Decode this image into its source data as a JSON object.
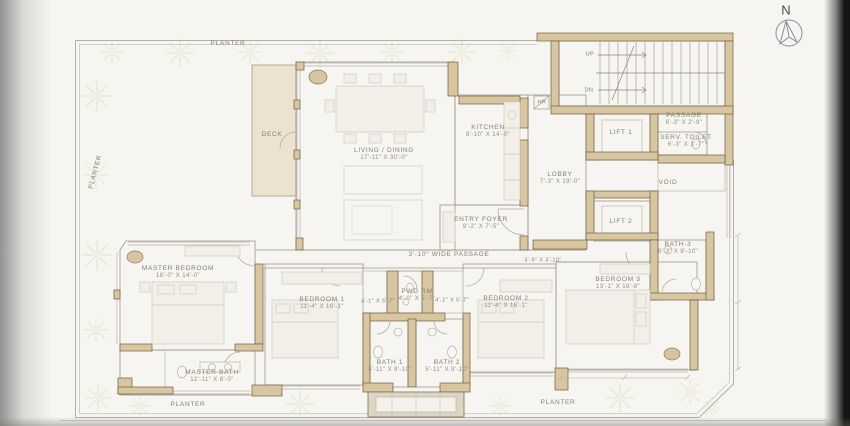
{
  "drawing": {
    "type": "apartment floor plan (scanned architectural drawing)"
  },
  "rooms": {
    "living_dining": {
      "name": "LIVING / DINING",
      "dims": "17'-11\" x 30'-0\""
    },
    "kitchen": {
      "name": "KITCHEN",
      "dims": "8'-10\" x 14'-0\""
    },
    "lobby": {
      "name": "LOBBY",
      "dims": "7'-3\" x 19'-0\""
    },
    "entry_foyer": {
      "name": "ENTRY FOYER",
      "dims": "9'-2\" x 7'-5\""
    },
    "lift1": {
      "name": "LIFT 1"
    },
    "lift2": {
      "name": "LIFT 2"
    },
    "passage": {
      "name": "PASSAGE",
      "dims": "6'-3\" x 2'-9\""
    },
    "serv_toilet": {
      "name": "SERV. TOILET",
      "dims": "6'-3\" x 3'-7\""
    },
    "void": {
      "name": "VOID"
    },
    "bath3": {
      "name": "BATH-3",
      "dims": "6'-3\" x 9'-10\""
    },
    "master_bedroom": {
      "name": "MASTER BEDROOM",
      "dims": "18'-0\" x 14'-0\""
    },
    "master_bath": {
      "name": "MASTER BATH",
      "dims": "12'-11\" x 6'-0\""
    },
    "bedroom1": {
      "name": "BEDROOM 1",
      "dims": "11'-4\" x 16'-1\""
    },
    "bedroom2": {
      "name": "BEDROOM 2",
      "dims": "11'-4\" x 16'-1\""
    },
    "bedroom3": {
      "name": "BEDROOM 3",
      "dims": "13'-1\" x 16'-9\""
    },
    "pwd_rm": {
      "name": "PWD RM",
      "dims": "4'-0\" x 5'-7\""
    },
    "bath1": {
      "name": "BATH 1",
      "dims": "5'-11\" x 9'-10\""
    },
    "bath2": {
      "name": "BATH 2",
      "dims": "5'-11\" x 9'-10\""
    },
    "deck": {
      "name": "DECK"
    }
  },
  "annotations": {
    "planter": "PLANTER",
    "up": "UP",
    "dn": "DN",
    "hr": "HR",
    "wide_passage": "3'-10\" WIDE PASSAGE",
    "dim_dress": "4'-1\" x 5'-7\"",
    "dim_foyer3": "3'-9\" x 3'-10\"",
    "north": "N"
  },
  "colors": {
    "wall_fill": "#d8c6a0",
    "wall_line": "#6e5f45",
    "thin_line": "#9e978a",
    "text": "#86806f",
    "planter_green": "#dfe5c6",
    "paper": "#f6f5f1",
    "scan_edge": "#161514"
  }
}
